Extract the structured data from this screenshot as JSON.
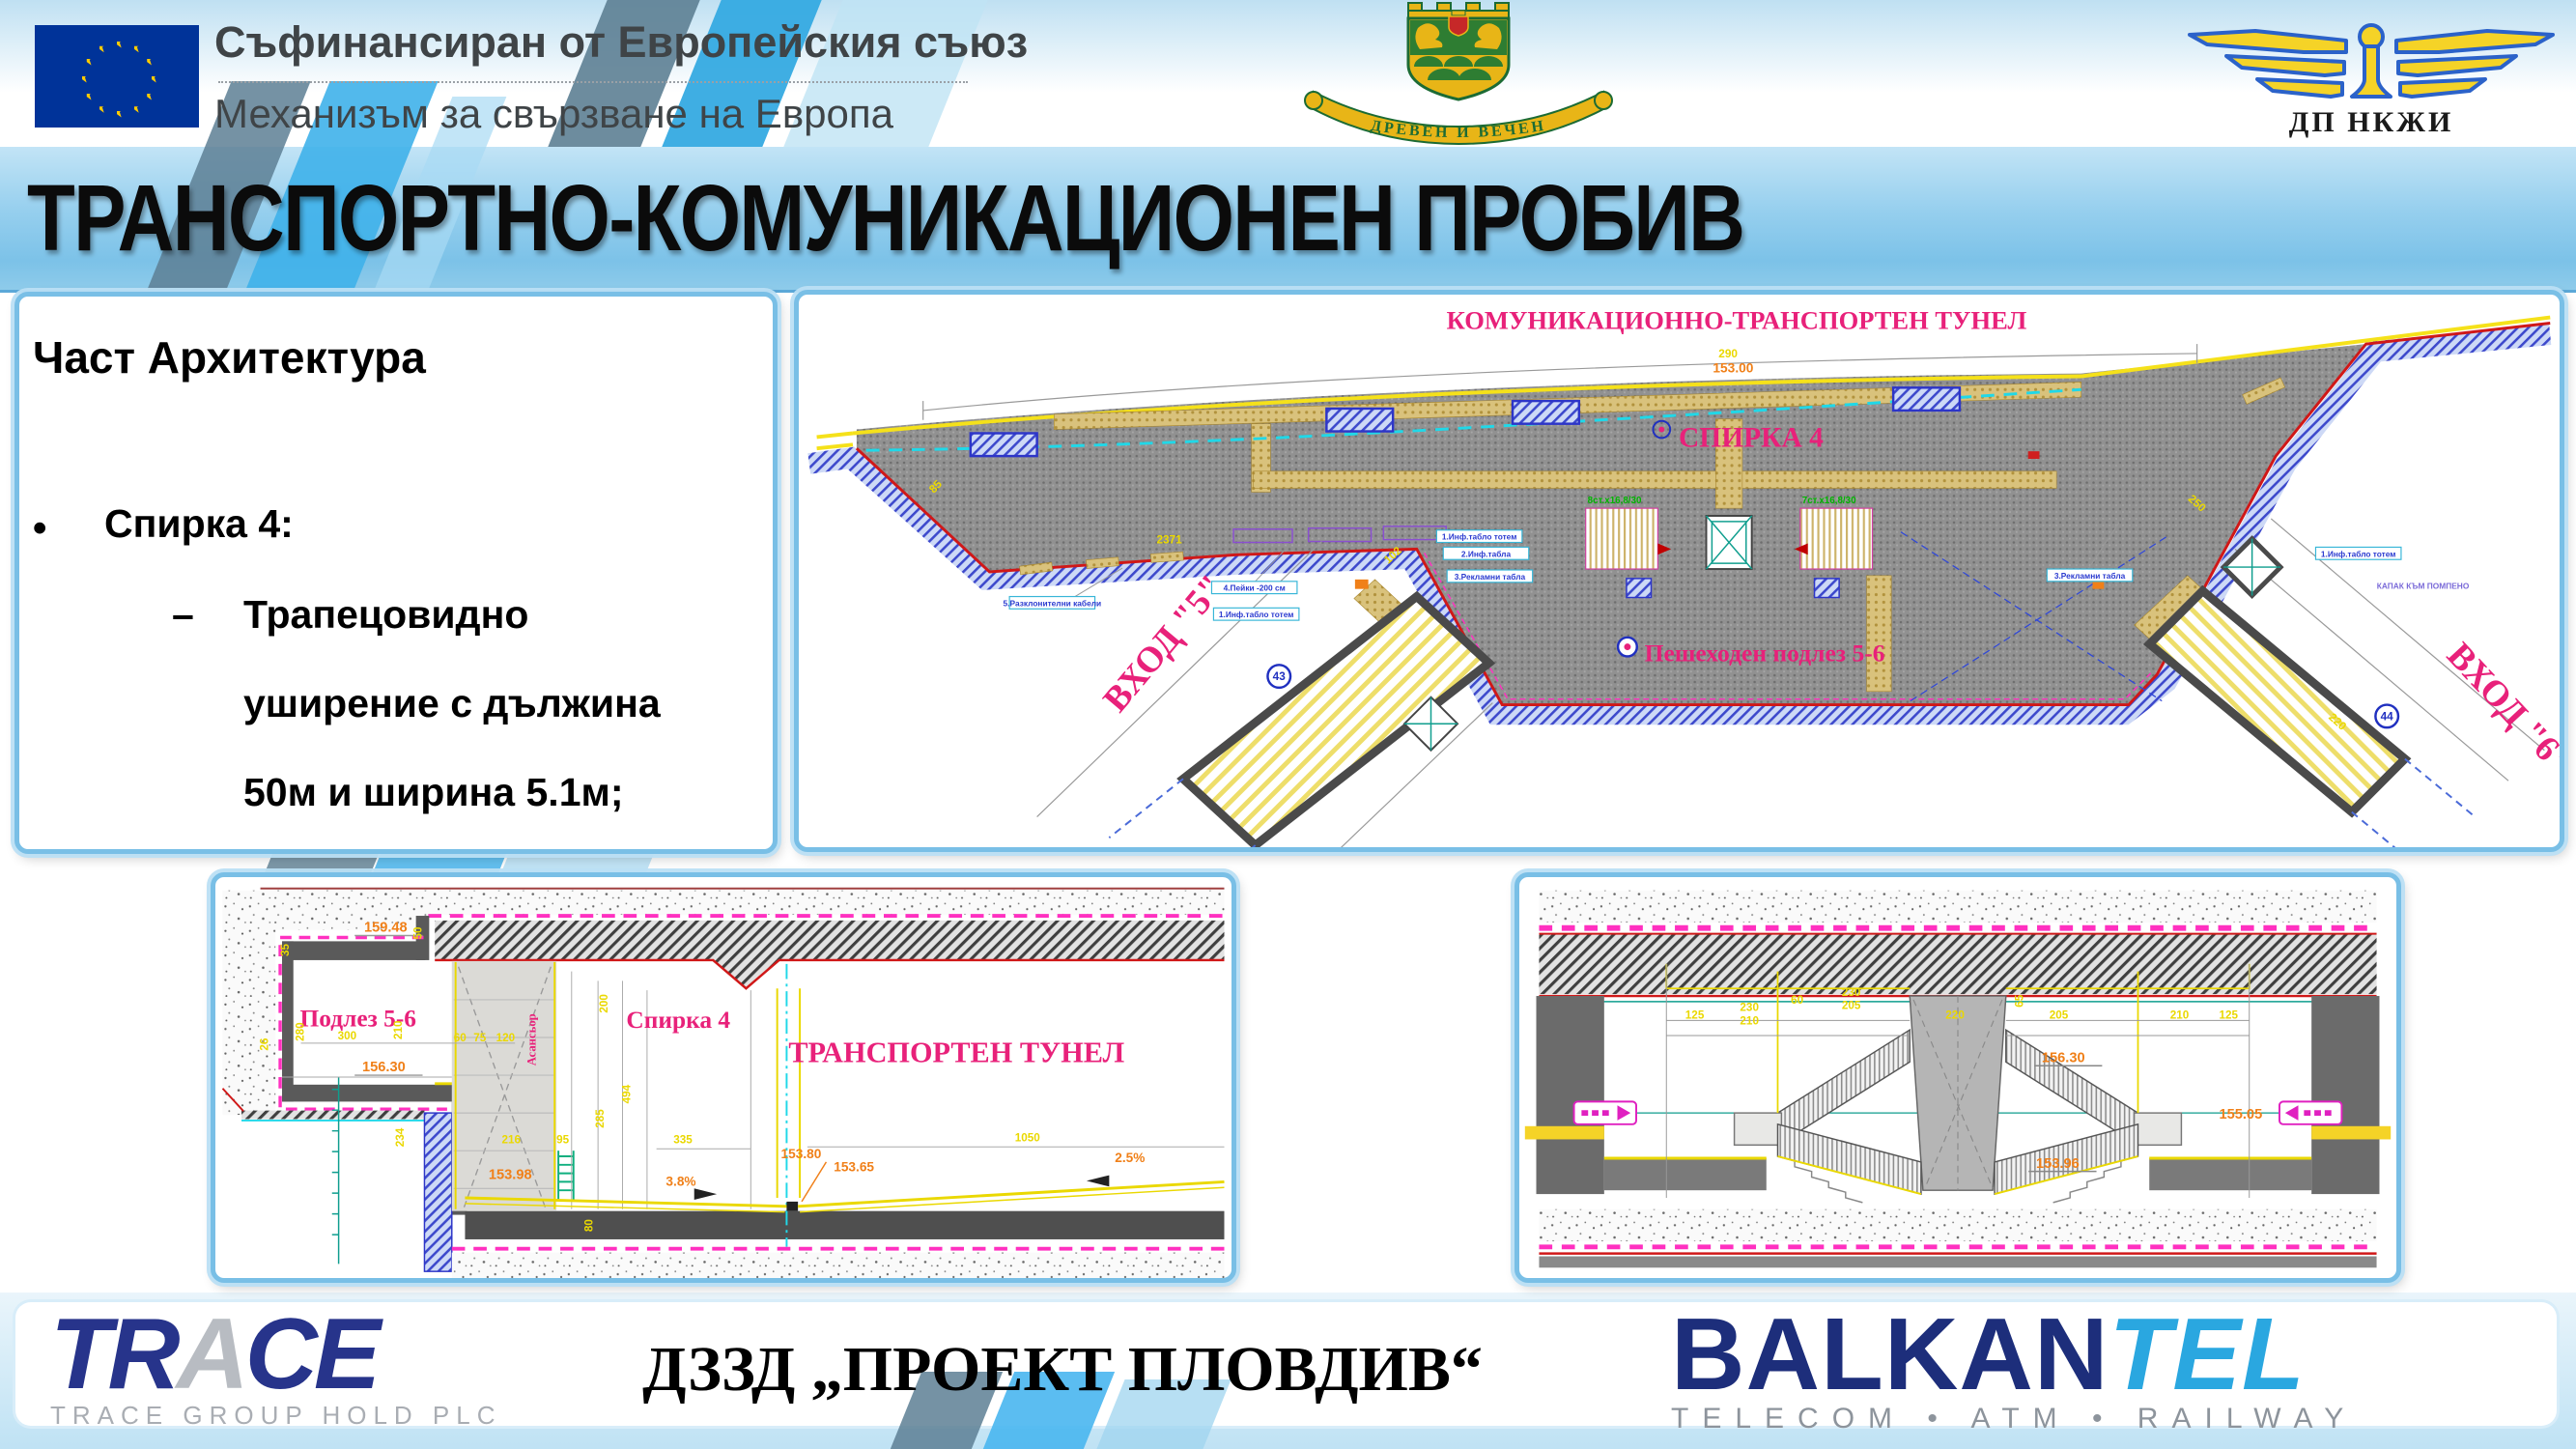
{
  "header": {
    "eu_line1": "Съфинансиран от Европейския съюз",
    "eu_line2": "Механизъм за свързване на Европа",
    "plovdiv_motto": "ДРЕВЕН И ВЕЧЕН",
    "railway_name": "ДП НКЖИ"
  },
  "title": "ТРАНСПОРТНО-КОМУНИКАЦИОНЕН ПРОБИВ",
  "left_panel": {
    "heading": "Част Архитектура",
    "bullet_marker": "•",
    "bullet": "Спирка 4:",
    "dash": "–",
    "sub_line1": "Трапецовидно",
    "sub_line2": "уширение с дължина",
    "sub_line3": "50м и ширина 5.1м;"
  },
  "plan": {
    "title": "КОМУНИКАЦИОННО-ТРАНСПОРТЕН ТУНЕЛ",
    "station": "СПИРКА 4",
    "underpass": "Пешеходен подлез 5-6",
    "entrance5": "ВХОД \"5\"",
    "entrance6": "ВХОД \"6\"",
    "badge5": "43",
    "badge6": "44",
    "stair_note_left": "8ст.х16,8/30",
    "stair_note_right": "7ст.х16,8/30",
    "elevation": "153.00",
    "dims": [
      "290",
      "2371",
      "250",
      "102",
      "220",
      "85"
    ],
    "callouts": [
      "5.Разклонителни кабели",
      "4.Пейки -200 см",
      "1.Инф.табло тотем",
      "2.Инф.табла",
      "3.Рекламни табла",
      "КАПАК КЪМ ПОМПЕНО"
    ]
  },
  "section_left": {
    "underpass": "Подлез 5-6",
    "station": "Спирка 4",
    "tunnel": "ТРАНСПОРТЕН ТУНЕЛ",
    "elevator": "Асансьор",
    "elevations": [
      "159.48",
      "156.30",
      "153.98",
      "153.80",
      "153.65"
    ],
    "slope_left": "3.8%",
    "slope_right": "2.5%",
    "dims": [
      "35",
      "50",
      "280",
      "300",
      "210",
      "26",
      "60",
      "75",
      "120",
      "200",
      "494",
      "285",
      "216",
      "335",
      "1050",
      "80",
      "234",
      "95"
    ]
  },
  "section_right": {
    "elevations": [
      "156.30",
      "155.05",
      "153.96"
    ],
    "dims": [
      "125",
      "230",
      "210",
      "60",
      "230",
      "205",
      "220",
      "65",
      "205",
      "210",
      "125"
    ]
  },
  "footer": {
    "trace_part1": "TR",
    "trace_part2": "A",
    "trace_part3": "CE",
    "trace_sub": "TRACE GROUP HOLD PLC",
    "consortium": "ДЗЗД  „ПРОЕКТ ПЛОВДИВ“",
    "balkan": "BALKAN",
    "tel": "TEL",
    "tagline": "TELECOM • ATM • RAILWAY"
  },
  "colors": {
    "accent_blue": "#2fa3e4",
    "title_band": "#8ecbea",
    "magenta": "#e8217a",
    "dim_yellow": "#ead800",
    "elev_orange": "#f08019",
    "eu_blue": "#003399",
    "navy": "#27348b",
    "balkan_navy": "#1d2e7b",
    "balkan_cyan": "#2aa7e0"
  }
}
